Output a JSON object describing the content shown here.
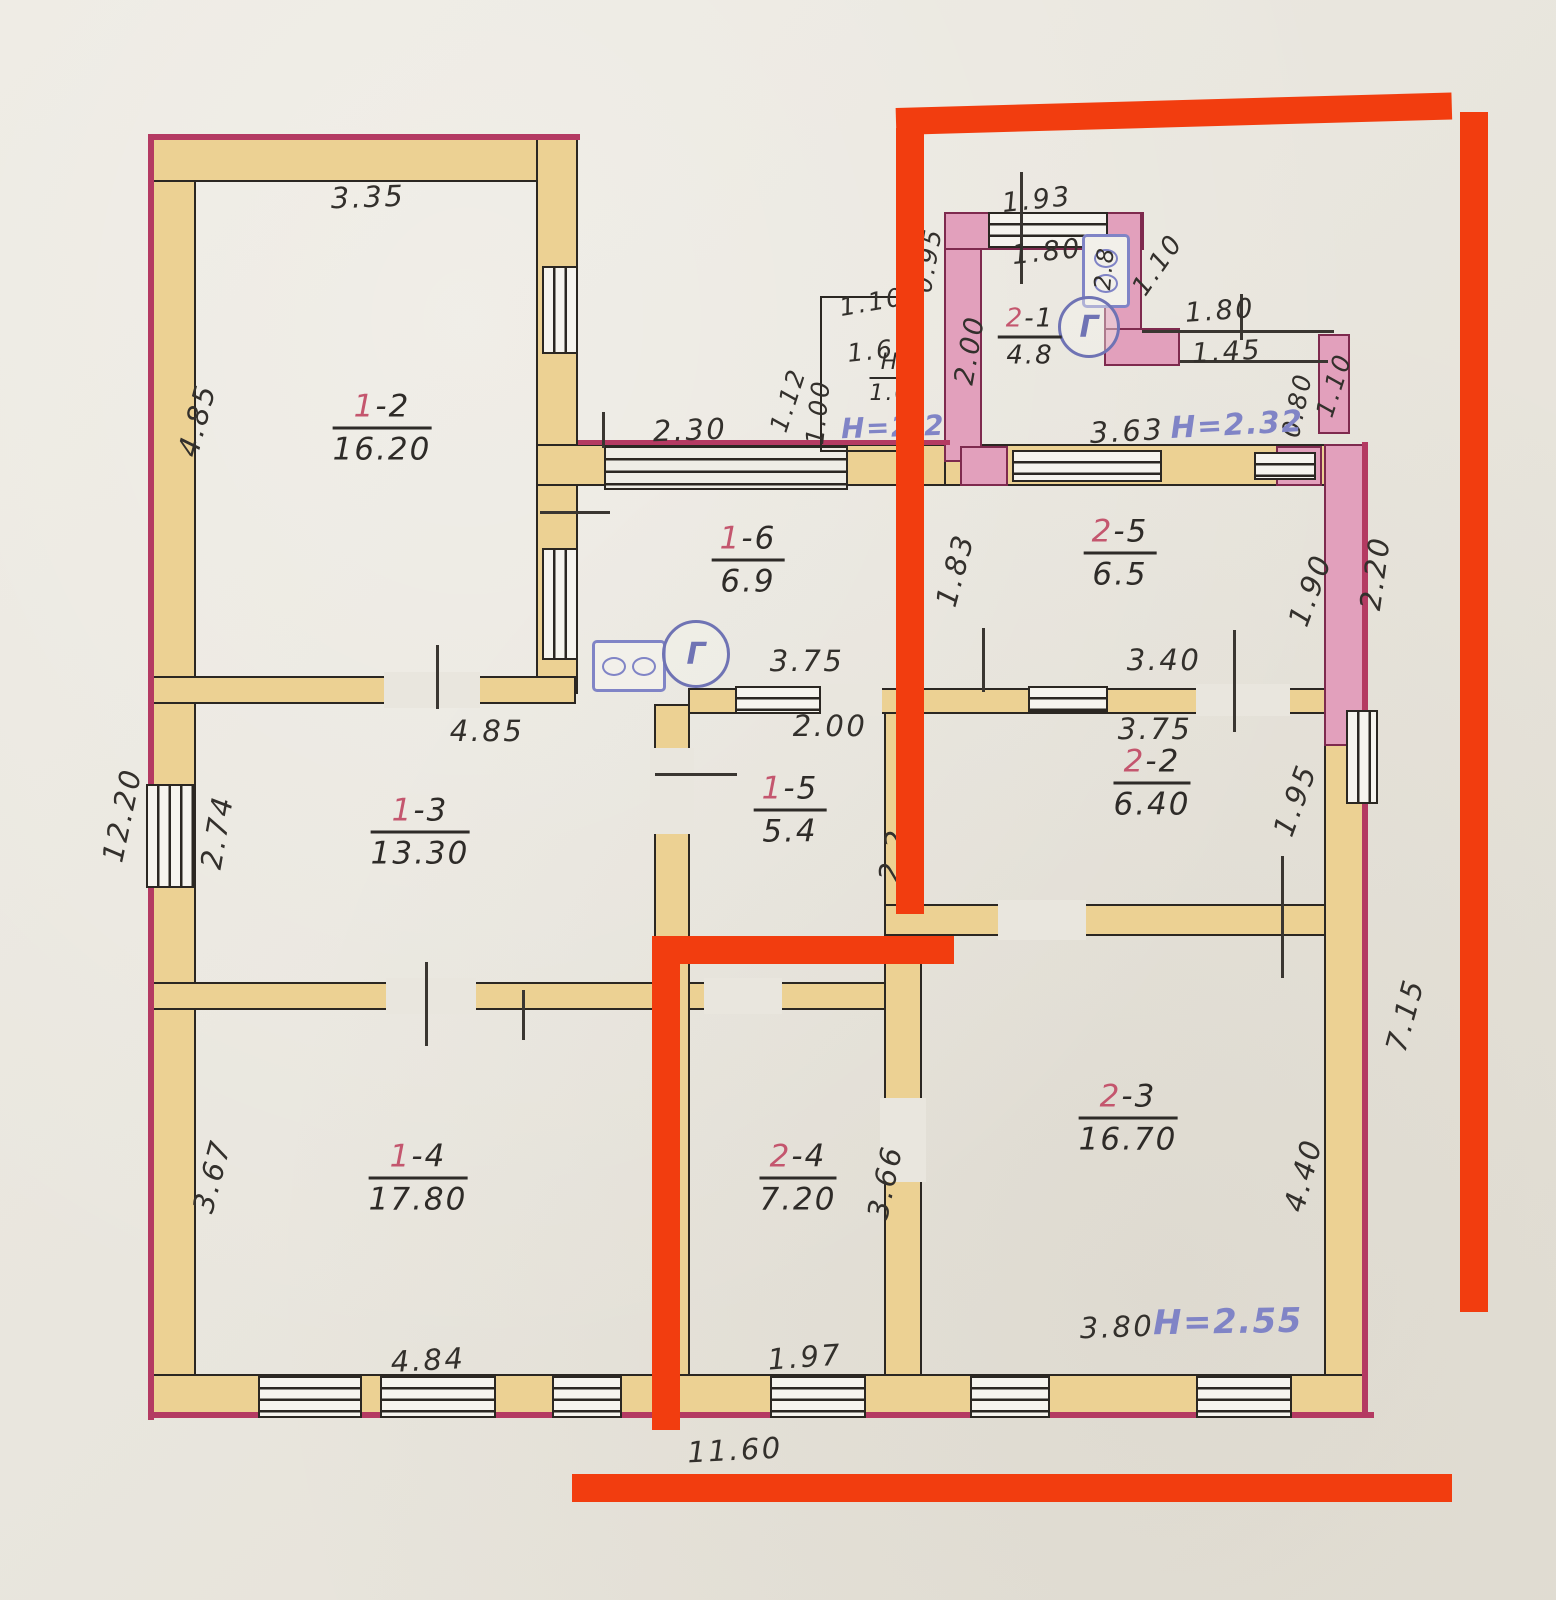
{
  "document": {
    "kind": "hand-drawn apartment floor plan (BTI scan) with red marker highlighting unit 2"
  },
  "colors": {
    "paper": "#e9e6de",
    "wall_fill": "#ecd193",
    "wall_line": "#2b2722",
    "outer_edge_crimson": "#b43a62",
    "pink_wall": "#e2a0bc",
    "pink_wall_line": "#7e2a4e",
    "marker_red": "#f23d0f",
    "ink_blue": "#8084c6",
    "pencil": "#33302c",
    "room_number_red": "#c4566e"
  },
  "rooms": {
    "r12": {
      "num": "1",
      "sep": "-2",
      "area": "16.20"
    },
    "r13": {
      "num": "1",
      "sep": "-3",
      "area": "13.30"
    },
    "r14": {
      "num": "1",
      "sep": "-4",
      "area": "17.80"
    },
    "r15": {
      "num": "1",
      "sep": "-5",
      "area": "5.4"
    },
    "r16": {
      "num": "1",
      "sep": "-6",
      "area": "6.9"
    },
    "r21": {
      "num": "2",
      "sep": "-1",
      "area": "4.8"
    },
    "r22": {
      "num": "2",
      "sep": "-2",
      "area": "6.40"
    },
    "r23": {
      "num": "2",
      "sep": "-3",
      "area": "16.70"
    },
    "r24": {
      "num": "2",
      "sep": "-4",
      "area": "7.20"
    },
    "r25": {
      "num": "2",
      "sep": "-5",
      "area": "6.5"
    },
    "vest": {
      "num": "Н",
      "area": "1.0"
    }
  },
  "dims": {
    "top_1_2": "3.35",
    "left_1_2": "4.85",
    "left_total": "12.20",
    "left_1_3": "2.74",
    "top_1_3": "4.85",
    "left_1_4": "3.67",
    "bottom_1_4": "4.84",
    "bottom_total": "11.60",
    "steps_width": "2.30",
    "porch_diag": "1.12",
    "porch_h": "1.00",
    "porch_top": "1.10",
    "porch_inner": "1.65",
    "kitchen_out_left": "0.95",
    "kitchen_top": "1.93",
    "kitchen_win": "1.80",
    "kitchen_left": "2.00",
    "stove_note": "2.8",
    "kitchen_diag": "1.10",
    "pass_top": "1.80",
    "pass_mid": "1.45",
    "pass_right_in": "0.80",
    "pass_right_out": "1.10",
    "pass_bottom": "3.63",
    "r25_left": "1.83",
    "r25_right_in": "1.90",
    "r25_right_out": "2.20",
    "r25_bottom": "3.40",
    "r16_bottom": "3.75",
    "r15_top": "2.00",
    "r22_top": "3.75",
    "r22_right": "1.95",
    "r22_left": "2.2",
    "right_lower": "7.15",
    "r23_right": "4.40",
    "r23_bottom": "3.80",
    "r24_right": "3.66",
    "r24_bottom": "1.97"
  },
  "heights": {
    "porch": "H=2.2",
    "passage": "H=2.32",
    "r23": "H=2.55"
  },
  "icons": {
    "gas_meter_1": "Г",
    "gas_meter_2": "Г"
  }
}
